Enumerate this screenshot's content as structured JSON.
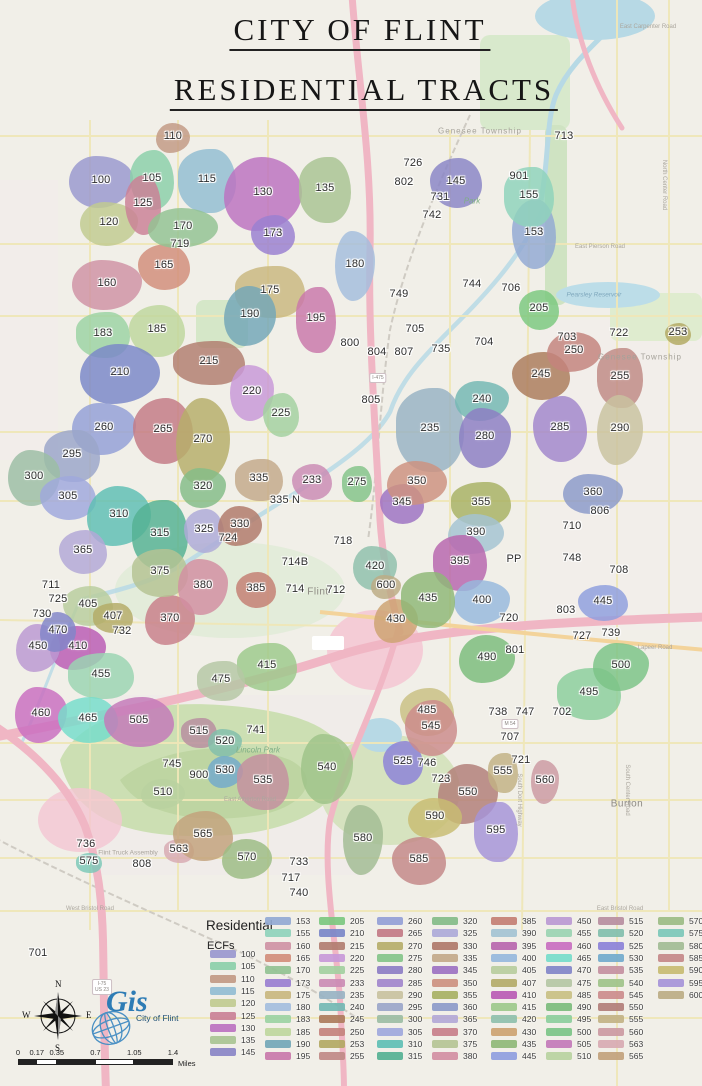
{
  "title": {
    "line1": "CITY OF FLINT",
    "line2": "RESIDENTIAL TRACTS"
  },
  "legend": {
    "header": "Residential",
    "subheader": "ECFs",
    "columns": [
      [
        "100",
        "105",
        "110",
        "115",
        "120",
        "125",
        "130",
        "135",
        "145"
      ],
      [
        "153",
        "155",
        "160",
        "165",
        "170",
        "173",
        "175",
        "180",
        "183",
        "185",
        "190",
        "195"
      ],
      [
        "205",
        "210",
        "215",
        "220",
        "225",
        "233",
        "235",
        "240",
        "245",
        "250",
        "253",
        "255"
      ],
      [
        "260",
        "265",
        "270",
        "275",
        "280",
        "285",
        "290",
        "295",
        "300",
        "305",
        "310",
        "315"
      ],
      [
        "320",
        "325",
        "330",
        "335",
        "345",
        "350",
        "355",
        "360",
        "365",
        "370",
        "375",
        "380"
      ],
      [
        "385",
        "390",
        "395",
        "400",
        "405",
        "407",
        "410",
        "415",
        "420",
        "430",
        "435",
        "445"
      ],
      [
        "450",
        "455",
        "460",
        "465",
        "470",
        "475",
        "485",
        "490",
        "495",
        "500",
        "505",
        "510"
      ],
      [
        "515",
        "520",
        "525",
        "530",
        "535",
        "540",
        "545",
        "550",
        "555",
        "560",
        "563",
        "565"
      ],
      [
        "570",
        "575",
        "580",
        "585",
        "590",
        "595",
        "600"
      ]
    ]
  },
  "ecf_colors": {
    "100": "#9a98ce",
    "105": "#8ccfa9",
    "110": "#c29a84",
    "115": "#93bdd2",
    "120": "#c1cb90",
    "125": "#ca8196",
    "130": "#bc72c0",
    "135": "#a9c493",
    "145": "#8a85c6",
    "153": "#93a9d3",
    "155": "#8fd3bb",
    "160": "#cf93a4",
    "165": "#d28e7b",
    "170": "#93c293",
    "173": "#9a7fd0",
    "175": "#c9b77f",
    "180": "#a4bedd",
    "183": "#9cd3a3",
    "185": "#bfd79d",
    "190": "#73a7b7",
    "195": "#c978aa",
    "205": "#7cc87f",
    "210": "#7b88c8",
    "215": "#b27e70",
    "220": "#c899d8",
    "225": "#a3d0a0",
    "233": "#cb8cb4",
    "235": "#99b3c3",
    "240": "#73b8b3",
    "245": "#ac7c5c",
    "250": "#c4837d",
    "253": "#b3a963",
    "255": "#c08a86",
    "260": "#94a0d6",
    "265": "#c37b85",
    "270": "#b6ae6a",
    "275": "#84c489",
    "280": "#8d7ec4",
    "285": "#a287cc",
    "290": "#c9c2a0",
    "295": "#9ba6c9",
    "300": "#9cbda4",
    "305": "#a0a8dc",
    "310": "#5fbfb4",
    "315": "#55b193",
    "320": "#84bc88",
    "325": "#aeaad8",
    "330": "#b07a6a",
    "335": "#c3a98a",
    "345": "#9d72c2",
    "350": "#cd9180",
    "355": "#a8b164",
    "360": "#8c9ac9",
    "365": "#b3a8d6",
    "370": "#c87f8a",
    "375": "#b5c494",
    "380": "#d28fa2",
    "385": "#c47f73",
    "390": "#a4c3d2",
    "395": "#b867ae",
    "400": "#97b9dc",
    "405": "#b9cd9d",
    "407": "#b4ab68",
    "410": "#ba5cb4",
    "415": "#9dc98b",
    "420": "#8fc0ac",
    "430": "#cda371",
    "435": "#8fb877",
    "445": "#8f9ede",
    "450": "#bb99d2",
    "455": "#9bd4b2",
    "460": "#c96fc0",
    "465": "#76dcca",
    "470": "#8286c8",
    "475": "#b5c7a4",
    "485": "#c9c083",
    "490": "#7cbc7c",
    "495": "#8cce9c",
    "500": "#7cc487",
    "505": "#c379b9",
    "510": "#b9d2a0",
    "515": "#b78ea0",
    "520": "#82bfac",
    "525": "#8c82d8",
    "530": "#72aacc",
    "535": "#c490a0",
    "540": "#9fc389",
    "545": "#cc8c8c",
    "550": "#b27e78",
    "555": "#c2b284",
    "560": "#cc9aa2",
    "563": "#d8aab2",
    "565": "#c2a27c",
    "570": "#9cbc84",
    "575": "#7cc8b8",
    "580": "#a2bc94",
    "585": "#c48888",
    "590": "#c8bc72",
    "595": "#a694d8",
    "600": "#bcac84"
  },
  "tracts": [
    [
      "100",
      101,
      180,
      64,
      52
    ],
    [
      "105",
      152,
      178,
      44,
      60
    ],
    [
      "110",
      173,
      136,
      34,
      30
    ],
    [
      "115",
      207,
      179,
      58,
      64
    ],
    [
      "120",
      109,
      222,
      58,
      44
    ],
    [
      "125",
      143,
      203,
      36,
      60
    ],
    [
      "130",
      263,
      192,
      78,
      74
    ],
    [
      "135",
      325,
      188,
      52,
      66
    ],
    [
      "145",
      456,
      181,
      52,
      50
    ],
    [
      "153",
      534,
      232,
      44,
      70
    ],
    [
      "155",
      529,
      195,
      50,
      60
    ],
    [
      "160",
      107,
      283,
      70,
      50
    ],
    [
      "165",
      164,
      265,
      52,
      46
    ],
    [
      "170",
      183,
      226,
      70,
      40
    ],
    [
      "173",
      273,
      233,
      44,
      40
    ],
    [
      "175",
      270,
      290,
      70,
      52
    ],
    [
      "180",
      355,
      264,
      40,
      70
    ],
    [
      "183",
      103,
      333,
      54,
      46
    ],
    [
      "185",
      157,
      329,
      56,
      52
    ],
    [
      "190",
      250,
      314,
      52,
      60
    ],
    [
      "195",
      316,
      318,
      40,
      66
    ],
    [
      "205",
      539,
      308,
      40,
      40
    ],
    [
      "210",
      120,
      372,
      80,
      60
    ],
    [
      "215",
      209,
      361,
      72,
      44
    ],
    [
      "220",
      252,
      391,
      44,
      56
    ],
    [
      "225",
      281,
      413,
      36,
      44
    ],
    [
      "233",
      312,
      480,
      40,
      36
    ],
    [
      "235",
      430,
      428,
      68,
      84
    ],
    [
      "240",
      482,
      399,
      54,
      40
    ],
    [
      "245",
      541,
      374,
      58,
      48
    ],
    [
      "250",
      574,
      350,
      54,
      40
    ],
    [
      "253",
      678,
      332,
      26,
      22
    ],
    [
      "255",
      620,
      376,
      46,
      60
    ],
    [
      "260",
      104,
      427,
      64,
      52
    ],
    [
      "265",
      163,
      429,
      60,
      66
    ],
    [
      "270",
      203,
      439,
      54,
      86
    ],
    [
      "275",
      357,
      482,
      30,
      36
    ],
    [
      "280",
      485,
      436,
      52,
      60
    ],
    [
      "285",
      560,
      427,
      54,
      66
    ],
    [
      "290",
      620,
      428,
      46,
      70
    ],
    [
      "295",
      72,
      454,
      56,
      52
    ],
    [
      "300",
      34,
      476,
      52,
      56
    ],
    [
      "305",
      68,
      496,
      56,
      44
    ],
    [
      "310",
      119,
      514,
      64,
      60
    ],
    [
      "315",
      160,
      533,
      56,
      70
    ],
    [
      "320",
      203,
      486,
      46,
      40
    ],
    [
      "325",
      204,
      529,
      40,
      44
    ],
    [
      "330",
      240,
      524,
      44,
      40
    ],
    [
      "335",
      259,
      478,
      48,
      42
    ],
    [
      "345",
      402,
      502,
      44,
      40
    ],
    [
      "350",
      417,
      481,
      60,
      44
    ],
    [
      "355",
      481,
      502,
      60,
      44
    ],
    [
      "360",
      593,
      492,
      60,
      40
    ],
    [
      "365",
      83,
      550,
      48,
      44
    ],
    [
      "370",
      170,
      618,
      50,
      50
    ],
    [
      "375",
      160,
      571,
      56,
      48
    ],
    [
      "380",
      203,
      585,
      50,
      56
    ],
    [
      "385",
      256,
      588,
      40,
      36
    ],
    [
      "390",
      476,
      532,
      56,
      40
    ],
    [
      "395",
      460,
      561,
      54,
      56
    ],
    [
      "400",
      482,
      600,
      56,
      44
    ],
    [
      "405",
      88,
      604,
      50,
      40
    ],
    [
      "407",
      113,
      616,
      40,
      30
    ],
    [
      "410",
      78,
      646,
      56,
      44
    ],
    [
      "415",
      267,
      665,
      60,
      48
    ],
    [
      "420",
      375,
      566,
      44,
      44
    ],
    [
      "430",
      396,
      619,
      44,
      44
    ],
    [
      "435",
      428,
      598,
      54,
      56
    ],
    [
      "445",
      603,
      601,
      50,
      36
    ],
    [
      "450",
      38,
      646,
      44,
      48
    ],
    [
      "455",
      101,
      674,
      66,
      46
    ],
    [
      "460",
      41,
      713,
      52,
      56
    ],
    [
      "465",
      88,
      718,
      60,
      46
    ],
    [
      "470",
      58,
      630,
      36,
      40
    ],
    [
      "475",
      221,
      679,
      48,
      40
    ],
    [
      "485",
      427,
      710,
      54,
      48
    ],
    [
      "490",
      487,
      657,
      56,
      48
    ],
    [
      "495",
      589,
      692,
      64,
      52
    ],
    [
      "500",
      621,
      665,
      56,
      48
    ],
    [
      "505",
      139,
      720,
      70,
      50
    ],
    [
      "510",
      163,
      792,
      44,
      30
    ],
    [
      "515",
      199,
      731,
      36,
      30
    ],
    [
      "520",
      225,
      741,
      34,
      28
    ],
    [
      "525",
      403,
      761,
      40,
      44
    ],
    [
      "530",
      225,
      770,
      36,
      32
    ],
    [
      "535",
      263,
      780,
      52,
      56
    ],
    [
      "540",
      327,
      767,
      52,
      70
    ],
    [
      "545",
      431,
      726,
      52,
      56
    ],
    [
      "550",
      468,
      792,
      60,
      60
    ],
    [
      "555",
      503,
      771,
      30,
      40
    ],
    [
      "560",
      545,
      780,
      28,
      44
    ],
    [
      "563",
      179,
      849,
      30,
      24
    ],
    [
      "565",
      203,
      834,
      60,
      50
    ],
    [
      "570",
      247,
      857,
      50,
      40
    ],
    [
      "575",
      89,
      861,
      26,
      20
    ],
    [
      "580",
      363,
      838,
      40,
      70
    ],
    [
      "585",
      419,
      859,
      54,
      48
    ],
    [
      "590",
      435,
      816,
      54,
      40
    ],
    [
      "595",
      496,
      830,
      44,
      60
    ],
    [
      "600",
      386,
      585,
      30,
      24
    ]
  ],
  "plain_labels": [
    [
      "713",
      564,
      136
    ],
    [
      "726",
      413,
      163
    ],
    [
      "802",
      404,
      182
    ],
    [
      "731",
      440,
      197
    ],
    [
      "742",
      432,
      215
    ],
    [
      "901",
      519,
      176
    ],
    [
      "744",
      472,
      284
    ],
    [
      "706",
      511,
      288
    ],
    [
      "749",
      399,
      294
    ],
    [
      "705",
      415,
      329
    ],
    [
      "800",
      350,
      343
    ],
    [
      "804",
      377,
      352
    ],
    [
      "807",
      404,
      352
    ],
    [
      "735",
      441,
      349
    ],
    [
      "704",
      484,
      342
    ],
    [
      "703",
      567,
      337
    ],
    [
      "722",
      619,
      333
    ],
    [
      "719",
      180,
      244
    ],
    [
      "805",
      371,
      400
    ],
    [
      "806",
      600,
      511
    ],
    [
      "710",
      572,
      526
    ],
    [
      "718",
      343,
      541
    ],
    [
      "714B",
      295,
      562
    ],
    [
      "PP",
      514,
      559
    ],
    [
      "748",
      572,
      558
    ],
    [
      "708",
      619,
      570
    ],
    [
      "714",
      295,
      589
    ],
    [
      "712",
      336,
      590
    ],
    [
      "711",
      51,
      585
    ],
    [
      "725",
      58,
      599
    ],
    [
      "730",
      42,
      614
    ],
    [
      "732",
      122,
      631
    ],
    [
      "803",
      566,
      610
    ],
    [
      "720",
      509,
      618
    ],
    [
      "727",
      582,
      636
    ],
    [
      "739",
      611,
      633
    ],
    [
      "801",
      515,
      650
    ],
    [
      "724",
      228,
      538
    ],
    [
      "335 N",
      285,
      500
    ],
    [
      "738",
      498,
      712
    ],
    [
      "747",
      525,
      712
    ],
    [
      "702",
      562,
      712
    ],
    [
      "707",
      510,
      737
    ],
    [
      "721",
      521,
      760
    ],
    [
      "746",
      427,
      763
    ],
    [
      "723",
      441,
      779
    ],
    [
      "741",
      256,
      730
    ],
    [
      "745",
      172,
      764
    ],
    [
      "900",
      199,
      775
    ],
    [
      "736",
      86,
      844
    ],
    [
      "808",
      142,
      864
    ],
    [
      "733",
      299,
      862
    ],
    [
      "717",
      291,
      878
    ],
    [
      "740",
      299,
      893
    ],
    [
      "701",
      38,
      953
    ]
  ],
  "basemap_labels": [
    {
      "text": "Park",
      "x": 472,
      "y": 201,
      "kind": "park"
    },
    {
      "text": "Genesee Township",
      "x": 480,
      "y": 131,
      "kind": "place"
    },
    {
      "text": "Genesee Township",
      "x": 640,
      "y": 357,
      "kind": "place"
    },
    {
      "text": "Flint",
      "x": 318,
      "y": 592,
      "kind": "city"
    },
    {
      "text": "Burton",
      "x": 627,
      "y": 804,
      "kind": "city"
    },
    {
      "text": "Pearsley Reservoir",
      "x": 594,
      "y": 295,
      "kind": "water"
    },
    {
      "text": "Lincoln Park",
      "x": 258,
      "y": 750,
      "kind": "park"
    },
    {
      "text": "Flint Truck Assembly",
      "x": 128,
      "y": 853,
      "kind": "poi"
    },
    {
      "text": "East Carpenter Road",
      "x": 648,
      "y": 27,
      "kind": "road"
    },
    {
      "text": "East Pierson Road",
      "x": 600,
      "y": 247,
      "kind": "road"
    },
    {
      "text": "Lapeer Road",
      "x": 655,
      "y": 648,
      "kind": "road"
    },
    {
      "text": "East Atherton Road",
      "x": 250,
      "y": 800,
      "kind": "road"
    },
    {
      "text": "West Bristol Road",
      "x": 90,
      "y": 909,
      "kind": "road"
    },
    {
      "text": "East Bristol Road",
      "x": 620,
      "y": 909,
      "kind": "road"
    },
    {
      "text": "North Center Road",
      "x": 664,
      "y": 185,
      "kind": "roadv"
    },
    {
      "text": "South Dort Highway",
      "x": 519,
      "y": 800,
      "kind": "roadv"
    },
    {
      "text": "South Center Road",
      "x": 627,
      "y": 790,
      "kind": "roadv"
    }
  ],
  "shields": [
    {
      "line1": "I-75",
      "line2": "US 23",
      "x": 102,
      "y": 987
    },
    {
      "line1": "I-475",
      "line2": "",
      "x": 378,
      "y": 378
    },
    {
      "line1": "M 54",
      "line2": "",
      "x": 510,
      "y": 724
    }
  ],
  "compass": {
    "n": "N",
    "e": "E",
    "s": "S",
    "w": "W"
  },
  "scalebar": {
    "ticks": [
      "0",
      "0.17",
      "0.35",
      "0.7",
      "1.05",
      "1.4"
    ],
    "unit": "Miles"
  },
  "logo": {
    "script": "Gis",
    "name": "City of Flint"
  }
}
